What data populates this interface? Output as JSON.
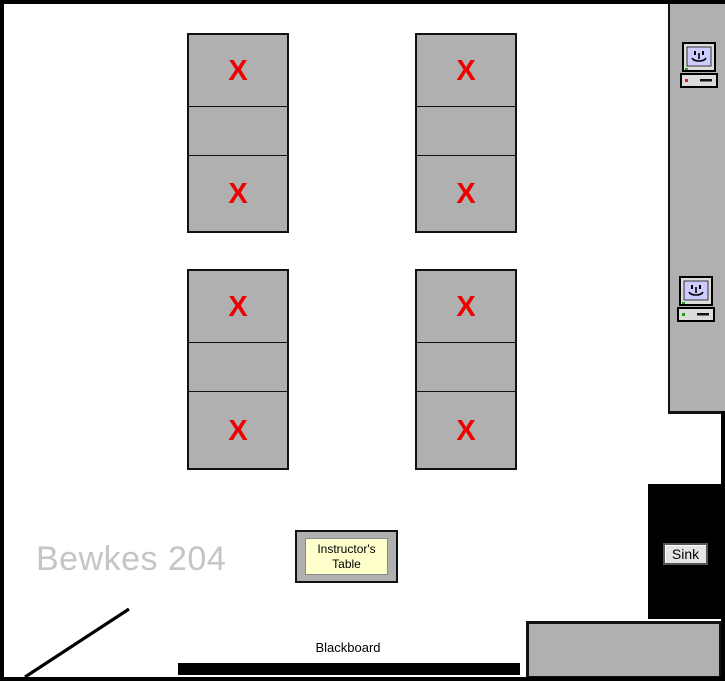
{
  "room": {
    "name": "Bewkes 204"
  },
  "labels": {
    "instructor_table": "Instructor's Table",
    "sink": "Sink",
    "blackboard": "Blackboard"
  },
  "tables": {
    "groups": [
      {
        "name": "top-left",
        "marks": [
          "X",
          "",
          "X"
        ]
      },
      {
        "name": "top-right",
        "marks": [
          "X",
          "",
          "X"
        ]
      },
      {
        "name": "bottom-left",
        "marks": [
          "X",
          "",
          "X"
        ]
      },
      {
        "name": "bottom-right",
        "marks": [
          "X",
          "",
          "X"
        ]
      }
    ]
  },
  "computers": [
    {
      "icon": "classic-mac-icon"
    },
    {
      "icon": "classic-mac-icon"
    }
  ],
  "colors": {
    "furniture_gray": "#b0b0b0",
    "mark_red": "#ee0000",
    "instructor_fill": "#ffffcc",
    "mac_screen": "#ccccff",
    "room_label_gray": "#c5c5c5",
    "sink_label_fill": "#e4e4e4"
  }
}
